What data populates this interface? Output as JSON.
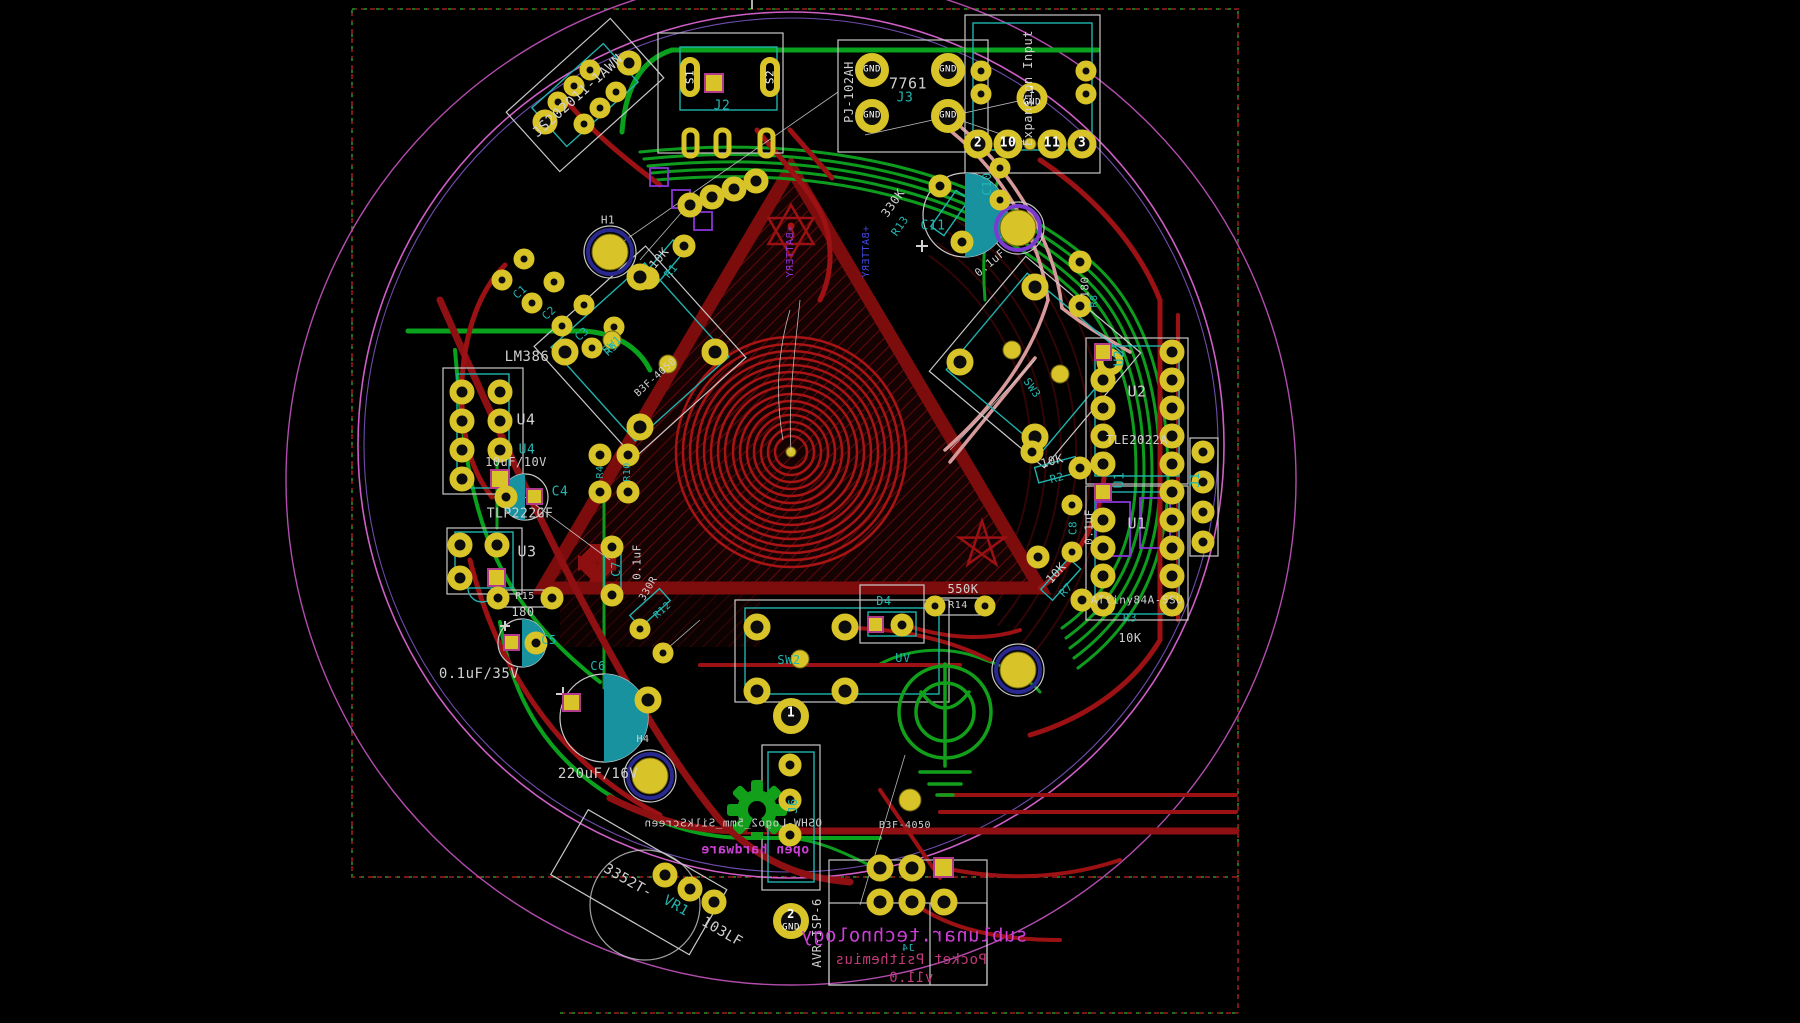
{
  "colors": {
    "silk": "#d0d0d0",
    "white": "#ffffff",
    "teal": "#22b7b0",
    "magenta": "#cc3fd6",
    "pinkred": "#c13a7a",
    "purple": "#8a35d6",
    "blue": "#4446e0"
  },
  "board": {
    "brand": "sublunar.technology",
    "product": "Pocket Psithemius",
    "version": "v11.0",
    "silk_footprint_note": "OSHW-Logo2_5mm_SilkScreen",
    "open_hardware_text": "open hardware"
  },
  "labels": [
    {
      "n": "ref-js-switch",
      "text": "JS202011-1AWN",
      "x": 578,
      "y": 96,
      "s": 14,
      "c": "silk",
      "r": -42
    },
    {
      "n": "pin-s1",
      "text": "S1",
      "x": 690,
      "y": 77,
      "s": 11,
      "c": "white",
      "r": -90
    },
    {
      "n": "pin-s2",
      "text": "S2",
      "x": 770,
      "y": 77,
      "s": 11,
      "c": "white",
      "r": -90
    },
    {
      "n": "ref-j2",
      "text": "J2",
      "x": 722,
      "y": 106,
      "s": 13,
      "c": "teal"
    },
    {
      "n": "part-pj102ah",
      "text": "PJ-102AH",
      "x": 849,
      "y": 92,
      "s": 12,
      "c": "silk",
      "r": -90
    },
    {
      "n": "part-7761",
      "text": "7761",
      "x": 908,
      "y": 84,
      "s": 15,
      "c": "silk"
    },
    {
      "n": "ref-j3",
      "text": "J3",
      "x": 905,
      "y": 98,
      "s": 13,
      "c": "teal"
    },
    {
      "n": "pad-gnd-1",
      "text": "GND",
      "x": 872,
      "y": 70,
      "s": 9,
      "c": "white"
    },
    {
      "n": "pad-gnd-2",
      "text": "GND",
      "x": 872,
      "y": 116,
      "s": 9,
      "c": "white"
    },
    {
      "n": "pad-gnd-3",
      "text": "GND",
      "x": 948,
      "y": 70,
      "s": 9,
      "c": "white"
    },
    {
      "n": "pad-gnd-4",
      "text": "GND",
      "x": 948,
      "y": 116,
      "s": 9,
      "c": "white"
    },
    {
      "n": "label-expansion-input",
      "text": "Expansion Input",
      "x": 1028,
      "y": 88,
      "s": 12,
      "c": "silk",
      "r": -90
    },
    {
      "n": "pad-1-num",
      "text": "1",
      "x": 1032,
      "y": 91,
      "s": 10,
      "c": "white"
    },
    {
      "n": "pad-1-gnd",
      "text": "GND",
      "x": 1032,
      "y": 103,
      "s": 9,
      "c": "white"
    },
    {
      "n": "pad-2-num",
      "text": "2",
      "x": 978,
      "y": 143,
      "s": 13,
      "c": "white",
      "b": true
    },
    {
      "n": "pad-10-num",
      "text": "10",
      "x": 1008,
      "y": 143,
      "s": 13,
      "c": "white",
      "b": true
    },
    {
      "n": "pad-11-num",
      "text": "11",
      "x": 1052,
      "y": 143,
      "s": 13,
      "c": "white",
      "b": true
    },
    {
      "n": "pad-3-num",
      "text": "3",
      "x": 1082,
      "y": 143,
      "s": 13,
      "c": "white",
      "b": true
    },
    {
      "n": "ref-h1",
      "text": "H1",
      "x": 608,
      "y": 220,
      "s": 11,
      "c": "silk"
    },
    {
      "n": "val-r1",
      "text": "10K",
      "x": 659,
      "y": 258,
      "s": 12,
      "c": "silk",
      "r": -50
    },
    {
      "n": "ref-r1",
      "text": "R1",
      "x": 671,
      "y": 271,
      "s": 11,
      "c": "teal",
      "r": -50
    },
    {
      "n": "silk-battery-b",
      "text": "+BATTERY",
      "x": 791,
      "y": 252,
      "s": 10,
      "c": "purple",
      "r": -90,
      "m": true
    },
    {
      "n": "silk-battery-f",
      "text": "+BATTERY",
      "x": 867,
      "y": 252,
      "s": 10,
      "c": "blue",
      "r": -90,
      "m": true
    },
    {
      "n": "ref-c1",
      "text": "C1",
      "x": 520,
      "y": 292,
      "s": 11,
      "c": "teal",
      "r": -42
    },
    {
      "n": "ref-c2",
      "text": "C2",
      "x": 549,
      "y": 313,
      "s": 11,
      "c": "teal",
      "r": -42
    },
    {
      "n": "ref-c3",
      "text": "C3",
      "x": 582,
      "y": 334,
      "s": 11,
      "c": "teal",
      "r": -42
    },
    {
      "n": "ref-r5",
      "text": "R5",
      "x": 611,
      "y": 349,
      "s": 11,
      "c": "teal",
      "r": -42
    },
    {
      "n": "part-lm386",
      "text": "LM386",
      "x": 527,
      "y": 357,
      "s": 14,
      "c": "silk"
    },
    {
      "n": "ref-u4",
      "text": "U4",
      "x": 526,
      "y": 420,
      "s": 15,
      "c": "silk"
    },
    {
      "n": "ref-u4-fab",
      "text": "U4",
      "x": 527,
      "y": 450,
      "s": 13,
      "c": "teal"
    },
    {
      "n": "val-u4",
      "text": "10uF/10V",
      "x": 516,
      "y": 462,
      "s": 12,
      "c": "silk"
    },
    {
      "n": "ref-c4",
      "text": "C4",
      "x": 560,
      "y": 492,
      "s": 13,
      "c": "teal"
    },
    {
      "n": "part-tlp222gf",
      "text": "TLP222GF",
      "x": 520,
      "y": 514,
      "s": 13,
      "c": "silk"
    },
    {
      "n": "ref-u3",
      "text": "U3",
      "x": 527,
      "y": 552,
      "s": 15,
      "c": "silk"
    },
    {
      "n": "ref-r15",
      "text": "R15",
      "x": 525,
      "y": 597,
      "s": 10,
      "c": "silk"
    },
    {
      "n": "val-r15",
      "text": "180",
      "x": 523,
      "y": 612,
      "s": 12,
      "c": "silk"
    },
    {
      "n": "ref-c5",
      "text": "C5",
      "x": 549,
      "y": 640,
      "s": 12,
      "c": "teal"
    },
    {
      "n": "val-c5",
      "text": "0.1uF/35V",
      "x": 479,
      "y": 674,
      "s": 14,
      "c": "silk"
    },
    {
      "n": "ref-c6",
      "text": "C6",
      "x": 598,
      "y": 666,
      "s": 12,
      "c": "teal"
    },
    {
      "n": "ref-c7",
      "text": "C7",
      "x": 616,
      "y": 569,
      "s": 12,
      "c": "teal",
      "r": -90
    },
    {
      "n": "val-c7",
      "text": "0.1uF",
      "x": 637,
      "y": 562,
      "s": 11,
      "c": "silk",
      "r": -90
    },
    {
      "n": "val-r12",
      "text": "330R",
      "x": 649,
      "y": 589,
      "s": 10,
      "c": "silk",
      "r": -60
    },
    {
      "n": "ref-r12",
      "text": "R12",
      "x": 663,
      "y": 611,
      "s": 10,
      "c": "teal",
      "r": -42
    },
    {
      "n": "val-c6",
      "text": "220uF/16V",
      "x": 598,
      "y": 774,
      "s": 14,
      "c": "silk"
    },
    {
      "n": "ref-sw1",
      "text": "SW1",
      "x": 612,
      "y": 345,
      "s": 11,
      "c": "teal",
      "r": -42
    },
    {
      "n": "part-sw1",
      "text": "B3F-4050",
      "x": 656,
      "y": 378,
      "s": 10,
      "c": "silk",
      "r": -42
    },
    {
      "n": "ref-r4",
      "text": "R4",
      "x": 601,
      "y": 472,
      "s": 10,
      "c": "teal",
      "r": -90
    },
    {
      "n": "ref-r10",
      "text": "R10",
      "x": 628,
      "y": 472,
      "s": 10,
      "c": "teal",
      "r": -90
    },
    {
      "n": "val-r13",
      "text": "330K",
      "x": 893,
      "y": 203,
      "s": 12,
      "c": "silk",
      "r": -55
    },
    {
      "n": "ref-r13",
      "text": "R13",
      "x": 900,
      "y": 226,
      "s": 11,
      "c": "teal",
      "r": -55
    },
    {
      "n": "ref-c11",
      "text": "C11",
      "x": 933,
      "y": 226,
      "s": 13,
      "c": "teal"
    },
    {
      "n": "val-c11",
      "text": "0.1uF",
      "x": 990,
      "y": 263,
      "s": 11,
      "c": "silk",
      "r": -40
    },
    {
      "n": "ref-c10",
      "text": "C10",
      "x": 987,
      "y": 184,
      "s": 12,
      "c": "teal",
      "r": -90
    },
    {
      "n": "val-r8",
      "text": "180",
      "x": 1085,
      "y": 287,
      "s": 11,
      "c": "silk",
      "r": -90
    },
    {
      "n": "ref-r8",
      "text": "R8",
      "x": 1095,
      "y": 301,
      "s": 10,
      "c": "teal",
      "r": -90
    },
    {
      "n": "ref-sw3",
      "text": "SW3",
      "x": 1032,
      "y": 388,
      "s": 11,
      "c": "teal",
      "r": 55
    },
    {
      "n": "val-r2",
      "text": "10K",
      "x": 1052,
      "y": 461,
      "s": 12,
      "c": "silk",
      "r": -15
    },
    {
      "n": "ref-r2",
      "text": "R2",
      "x": 1057,
      "y": 478,
      "s": 11,
      "c": "teal",
      "r": -15
    },
    {
      "n": "ref-c8",
      "text": "C8",
      "x": 1073,
      "y": 528,
      "s": 11,
      "c": "teal",
      "r": -90
    },
    {
      "n": "val-c8",
      "text": "0.1uF",
      "x": 1089,
      "y": 527,
      "s": 11,
      "c": "silk",
      "r": -90
    },
    {
      "n": "val-r7",
      "text": "10K",
      "x": 1056,
      "y": 573,
      "s": 12,
      "c": "silk",
      "r": -48
    },
    {
      "n": "ref-r7",
      "text": "R7",
      "x": 1066,
      "y": 590,
      "s": 11,
      "c": "teal",
      "r": -48
    },
    {
      "n": "ref-u2-fab",
      "text": "U2",
      "x": 1120,
      "y": 358,
      "s": 13,
      "c": "teal",
      "r": -90
    },
    {
      "n": "ref-u2",
      "text": "U2",
      "x": 1137,
      "y": 392,
      "s": 15,
      "c": "silk"
    },
    {
      "n": "part-u1",
      "text": "TLE2022A",
      "x": 1137,
      "y": 440,
      "s": 12,
      "c": "silk"
    },
    {
      "n": "ref-u1-fab",
      "text": "U1",
      "x": 1120,
      "y": 480,
      "s": 13,
      "c": "teal",
      "r": -90
    },
    {
      "n": "ref-u1",
      "text": "U1",
      "x": 1137,
      "y": 524,
      "s": 15,
      "c": "silk"
    },
    {
      "n": "part-u2",
      "text": "ATtiny84A-SSU",
      "x": 1137,
      "y": 600,
      "s": 11,
      "c": "silk"
    },
    {
      "n": "ref-r3",
      "text": "R3",
      "x": 1130,
      "y": 618,
      "s": 11,
      "c": "teal"
    },
    {
      "n": "val-r3",
      "text": "10K",
      "x": 1130,
      "y": 638,
      "s": 12,
      "c": "silk"
    },
    {
      "n": "ref-j1",
      "text": "J1",
      "x": 1195,
      "y": 480,
      "s": 12,
      "c": "teal",
      "r": -90
    },
    {
      "n": "val-r14",
      "text": "550K",
      "x": 963,
      "y": 589,
      "s": 12,
      "c": "silk"
    },
    {
      "n": "ref-r14",
      "text": "R14",
      "x": 958,
      "y": 606,
      "s": 10,
      "c": "silk"
    },
    {
      "n": "ref-d4",
      "text": "D4",
      "x": 884,
      "y": 601,
      "s": 12,
      "c": "teal"
    },
    {
      "n": "ref-uv",
      "text": "UV",
      "x": 903,
      "y": 658,
      "s": 12,
      "c": "teal"
    },
    {
      "n": "ref-sw2",
      "text": "SW2",
      "x": 789,
      "y": 660,
      "s": 12,
      "c": "teal"
    },
    {
      "n": "part-sw2",
      "text": "B3F-4050",
      "x": 905,
      "y": 826,
      "s": 10,
      "c": "silk"
    },
    {
      "n": "ref-j6",
      "text": "J6",
      "x": 793,
      "y": 806,
      "s": 12,
      "c": "teal",
      "r": -90
    },
    {
      "n": "pad-j6-1",
      "text": "1",
      "x": 791,
      "y": 713,
      "s": 13,
      "c": "white",
      "b": true
    },
    {
      "n": "pad-j6-2",
      "text": "2",
      "x": 791,
      "y": 914,
      "s": 12,
      "c": "white",
      "b": true
    },
    {
      "n": "pad-j6-2-gnd",
      "text": "GND",
      "x": 791,
      "y": 928,
      "s": 9,
      "c": "white"
    },
    {
      "n": "ref-avr-isp",
      "text": "AVR-ISP-6",
      "x": 817,
      "y": 933,
      "s": 12,
      "c": "silk",
      "r": -90
    },
    {
      "n": "brand-sublunar",
      "text": "sublunar.technology",
      "x": 914,
      "y": 936,
      "s": 19,
      "c": "magenta",
      "m": true
    },
    {
      "n": "brand-pocket",
      "text": "Pocket Psithemius",
      "x": 911,
      "y": 960,
      "s": 14,
      "c": "pinkred",
      "m": true
    },
    {
      "n": "brand-version",
      "text": "v11.0",
      "x": 911,
      "y": 978,
      "s": 14,
      "c": "pinkred",
      "m": true
    },
    {
      "n": "ref-j4",
      "text": "J4",
      "x": 908,
      "y": 949,
      "s": 10,
      "c": "teal",
      "m": true
    },
    {
      "n": "part-vr1-a",
      "text": "3352T-",
      "x": 628,
      "y": 881,
      "s": 14,
      "c": "silk",
      "r": 30
    },
    {
      "n": "ref-vr1",
      "text": "VR1",
      "x": 676,
      "y": 906,
      "s": 14,
      "c": "teal",
      "r": 30
    },
    {
      "n": "part-vr1-b",
      "text": "103LF",
      "x": 722,
      "y": 932,
      "s": 14,
      "c": "silk",
      "r": 30
    },
    {
      "n": "silk-oshw-name",
      "text": "OSHW-Logo2_5mm_SilkScreen",
      "x": 733,
      "y": 823,
      "s": 11,
      "c": "silk",
      "m": true
    },
    {
      "n": "silk-open-hardware",
      "text": "open hardware",
      "x": 755,
      "y": 850,
      "s": 13,
      "c": "magenta",
      "m": true,
      "b": true
    },
    {
      "n": "ref-h4",
      "text": "H4",
      "x": 643,
      "y": 740,
      "s": 10,
      "c": "silk"
    }
  ]
}
